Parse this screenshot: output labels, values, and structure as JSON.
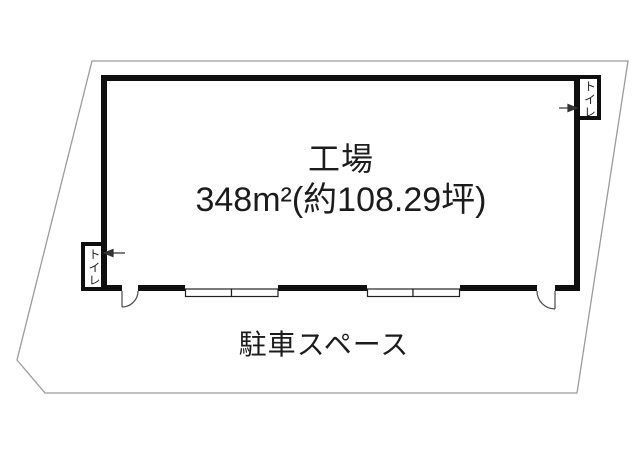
{
  "floorplan": {
    "room": {
      "label": "工場",
      "area": "348m²(約108.29坪)"
    },
    "parking": {
      "label": "駐車スペース"
    },
    "toilets": [
      {
        "label": "トイレ",
        "position": "top-right"
      },
      {
        "label": "トイレ",
        "position": "bottom-left"
      }
    ],
    "colors": {
      "wall": "#0f0f0f",
      "boundary": "#9b9b9b",
      "door": "#4a4a4a",
      "background": "#ffffff",
      "text": "#1c1c1c"
    }
  }
}
